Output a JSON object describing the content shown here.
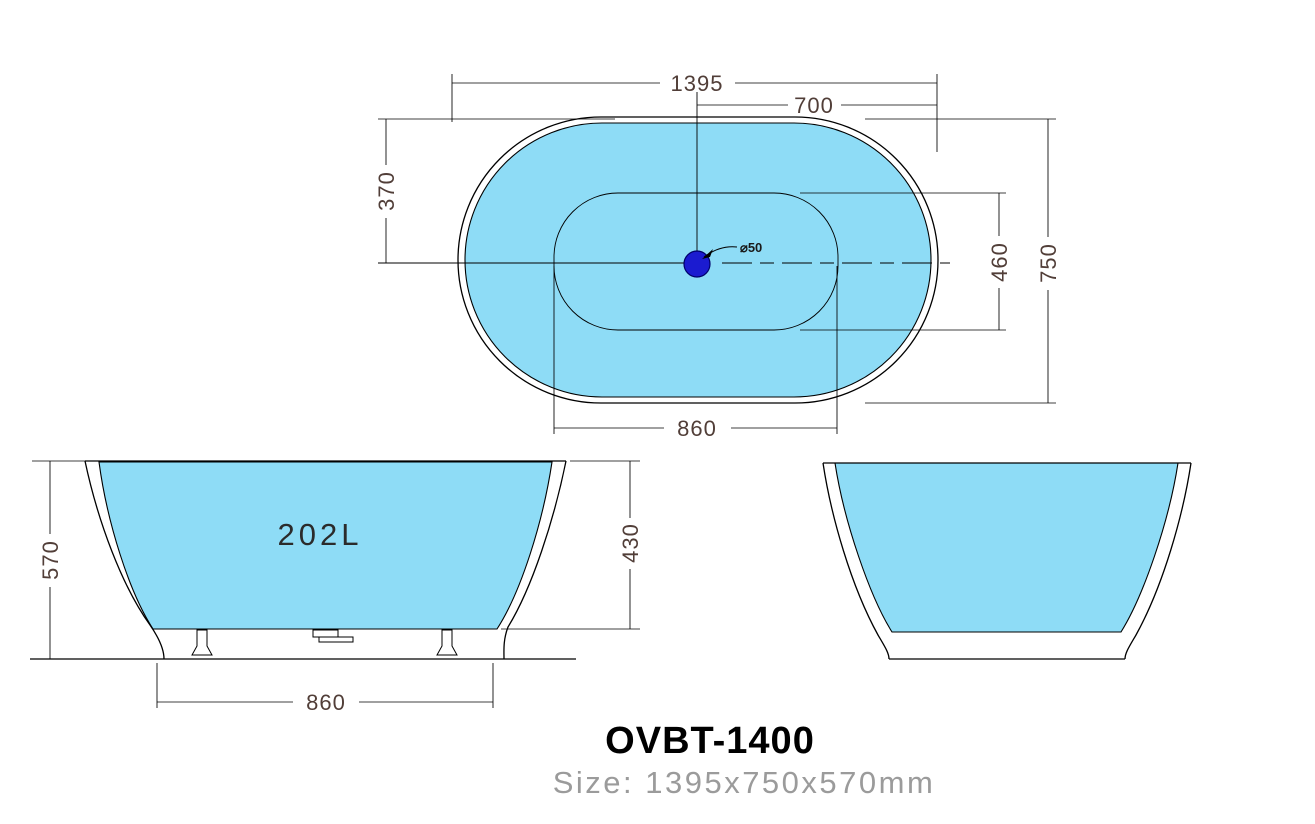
{
  "title_block": {
    "model": "OVBT-1400",
    "size_caption": "Size: 1395x750x570mm"
  },
  "top_view": {
    "dim_overall_length": "1395",
    "dim_center_to_end": "700",
    "dim_rim_to_centerline": "370",
    "dim_basin_width": "460",
    "dim_overall_width": "750",
    "dim_basin_length": "860",
    "drain_label": "⌀50"
  },
  "front_view": {
    "capacity": "202L",
    "dim_overall_height": "570",
    "dim_inner_depth": "430",
    "dim_base_length": "860"
  },
  "colors": {
    "water_fill": "#8edcf6",
    "drain_fill": "#1b1bd0",
    "outline": "#000000",
    "dimension_text": "#513e38",
    "subtitle_gray": "#9b9b9b"
  }
}
